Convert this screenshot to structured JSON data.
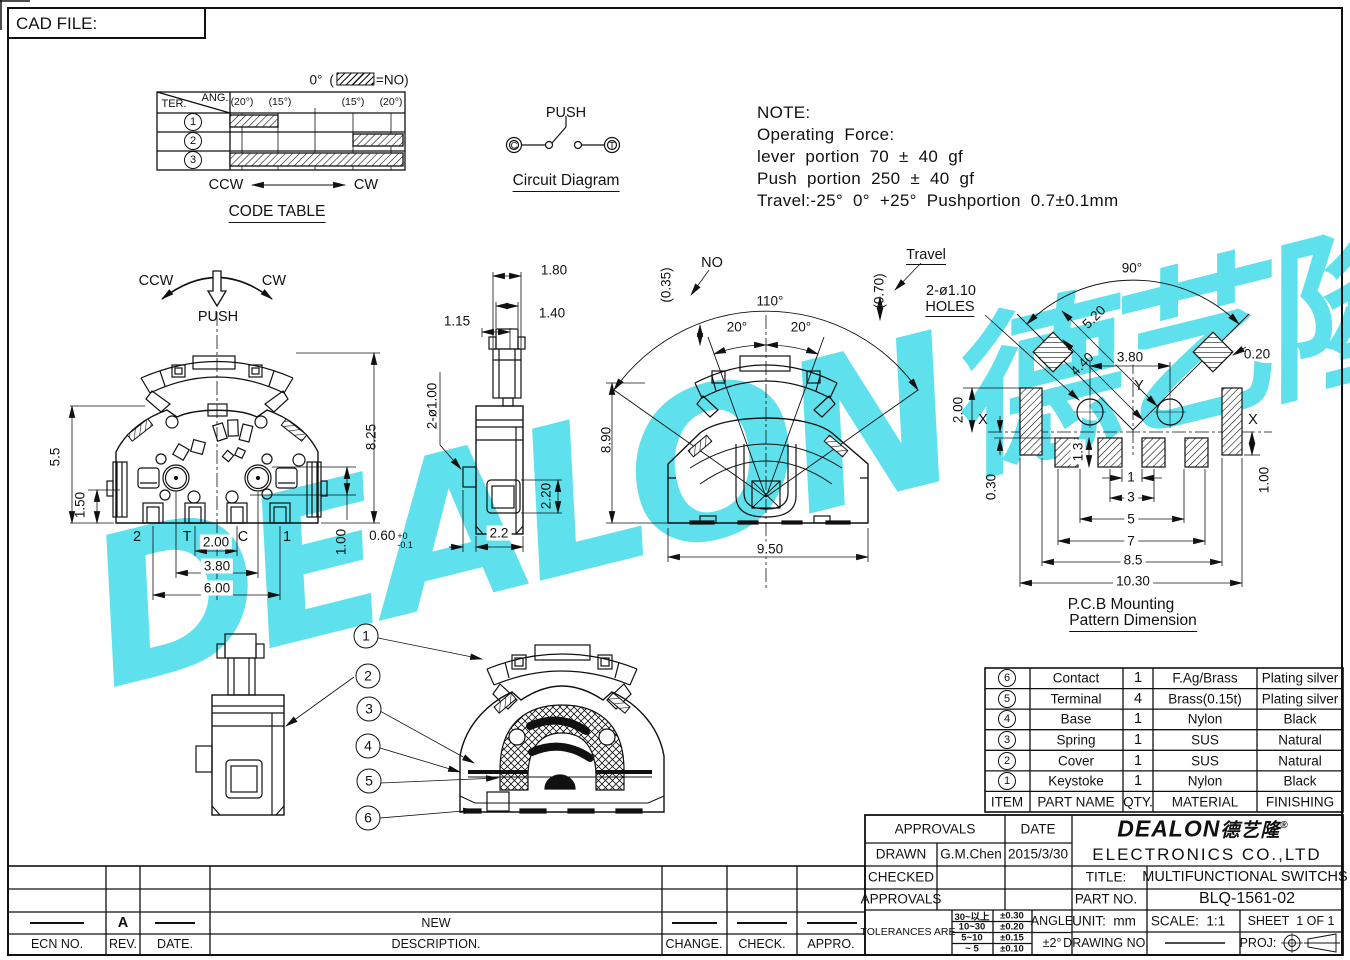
{
  "page": {
    "cad_file": "CAD FILE:"
  },
  "colors": {
    "watermark": "#42dce9",
    "line": "#111111"
  },
  "watermark": {
    "main": "DEALON",
    "cn": "德艺隆",
    "reg": "®"
  },
  "code_table": {
    "zero": "0°",
    "legend_open": "(",
    "legend_eq": "=NO)",
    "ter": "TER.",
    "ang": "ANG.",
    "col1": "(20°)",
    "col2": "(15°)",
    "col3": "(15°)",
    "col4": "(20°)",
    "r1": "1",
    "r2": "2",
    "r3": "3",
    "ccw": "CCW",
    "cw": "CW",
    "title": "CODE TABLE"
  },
  "circuit": {
    "push": "PUSH",
    "caption": "Circuit Diagram",
    "left": "C",
    "right": "T"
  },
  "note": {
    "l1": "NOTE:",
    "l2": "Operating Force:",
    "l3": "lever portion 70 ± 40 gf",
    "l4": "Push portion 250 ± 40 gf",
    "l5": "Travel:-25° 0° +25° Pushportion 0.7±0.1mm"
  },
  "front": {
    "ccw": "CCW",
    "cw": "CW",
    "push": "PUSH",
    "h55": "5.5",
    "h150": "1.50",
    "h825": "8.25",
    "h100": "1.00",
    "w060": "0.60",
    "w060sup": "+0",
    "w060sub": "-0.1",
    "t2": "2",
    "tT": "T",
    "tC": "C",
    "t1": "1",
    "w200": "2.00",
    "w380": "3.80",
    "w600": "6.00"
  },
  "side": {
    "w180": "1.80",
    "w140": "1.40",
    "w115": "1.15",
    "holes": "2-ø1.00",
    "h220": "2.20",
    "w22": "2.2"
  },
  "center": {
    "g035": "(0.35)",
    "no": "NO",
    "a110": "110°",
    "a20l": "20°",
    "a20r": "20°",
    "h890": "8.90",
    "w950": "9.50",
    "g070": "(0.70)",
    "travel": "Travel"
  },
  "pcb": {
    "a90": "90°",
    "d520": "5.20",
    "d440": "4.40",
    "w380": "3.80",
    "d020": "0.20",
    "h200": "2.00",
    "xl": "X",
    "xr": "X",
    "y": "Y",
    "h13": "1.3",
    "h030": "0.30",
    "s1": "1",
    "s3": "3",
    "s5": "5",
    "s7": "7",
    "s85": "8.5",
    "s1030": "10.30",
    "h100": "1.00",
    "holes1": "2-ø1.10",
    "holes2": "HOLES",
    "cap1": "P.C.B Mounting",
    "cap2": "Pattern Dimension"
  },
  "callouts": {
    "c1": "1",
    "c2": "2",
    "c3": "3",
    "c4": "4",
    "c5": "5",
    "c6": "6"
  },
  "bom": {
    "h_item": "ITEM",
    "h_part": "PART NAME",
    "h_qty": "QTY.",
    "h_mat": "MATERIAL",
    "h_fin": "FINISHING",
    "rows": [
      {
        "item": "6",
        "part": "Contact",
        "qty": "1",
        "mat": "F.Ag/Brass",
        "fin": "Plating silver"
      },
      {
        "item": "5",
        "part": "Terminal",
        "qty": "4",
        "mat": "Brass(0.15t)",
        "fin": "Plating silver"
      },
      {
        "item": "4",
        "part": "Base",
        "qty": "1",
        "mat": "Nylon",
        "fin": "Black"
      },
      {
        "item": "3",
        "part": "Spring",
        "qty": "1",
        "mat": "SUS",
        "fin": "Natural"
      },
      {
        "item": "2",
        "part": "Cover",
        "qty": "1",
        "mat": "SUS",
        "fin": "Natural"
      },
      {
        "item": "1",
        "part": "Keystoke",
        "qty": "1",
        "mat": "Nylon",
        "fin": "Black"
      }
    ]
  },
  "title_block": {
    "approvals": "APPROVALS",
    "date": "DATE",
    "drawn": "DRAWN",
    "drawn_by": "G.M.Chen",
    "drawn_date": "2015/3/30",
    "checked": "CHECKED",
    "approvals2": "APPROVALS",
    "tolerances": "TOLERANCES ARE",
    "tol": [
      {
        "range": "30~以上",
        "val": "±0.30"
      },
      {
        "range": "10~30",
        "val": "±0.20"
      },
      {
        "range": "5~10",
        "val": "±0.15"
      },
      {
        "range": "~ 5",
        "val": "±0.10"
      }
    ],
    "angle": "ANGLE",
    "angle_val": "±2°",
    "logo": "DEALON",
    "logo_cn": "德艺隆",
    "logo_reg": "®",
    "company": "ELECTRONICS CO.,LTD",
    "title_label": "TITLE:",
    "title": "MULTIFUNCTIONAL SWITCHS",
    "part_label": "PART NO.",
    "part_no": "BLQ-1561-02",
    "unit_label": "UNIT:",
    "unit": "mm",
    "scale_label": "SCALE:",
    "scale": "1:1",
    "sheet_label": "SHEET",
    "sheet": "1 OF 1",
    "drawing_label": "DRAWING NO.",
    "proj_label": "PROJ:"
  },
  "revision": {
    "rev_a": "A",
    "desc_new": "NEW",
    "ecn": "ECN NO.",
    "rev": "REV.",
    "date": "DATE.",
    "desc": "DESCRIPTION.",
    "change": "CHANGE.",
    "check": "CHECK.",
    "appro": "APPRO."
  }
}
